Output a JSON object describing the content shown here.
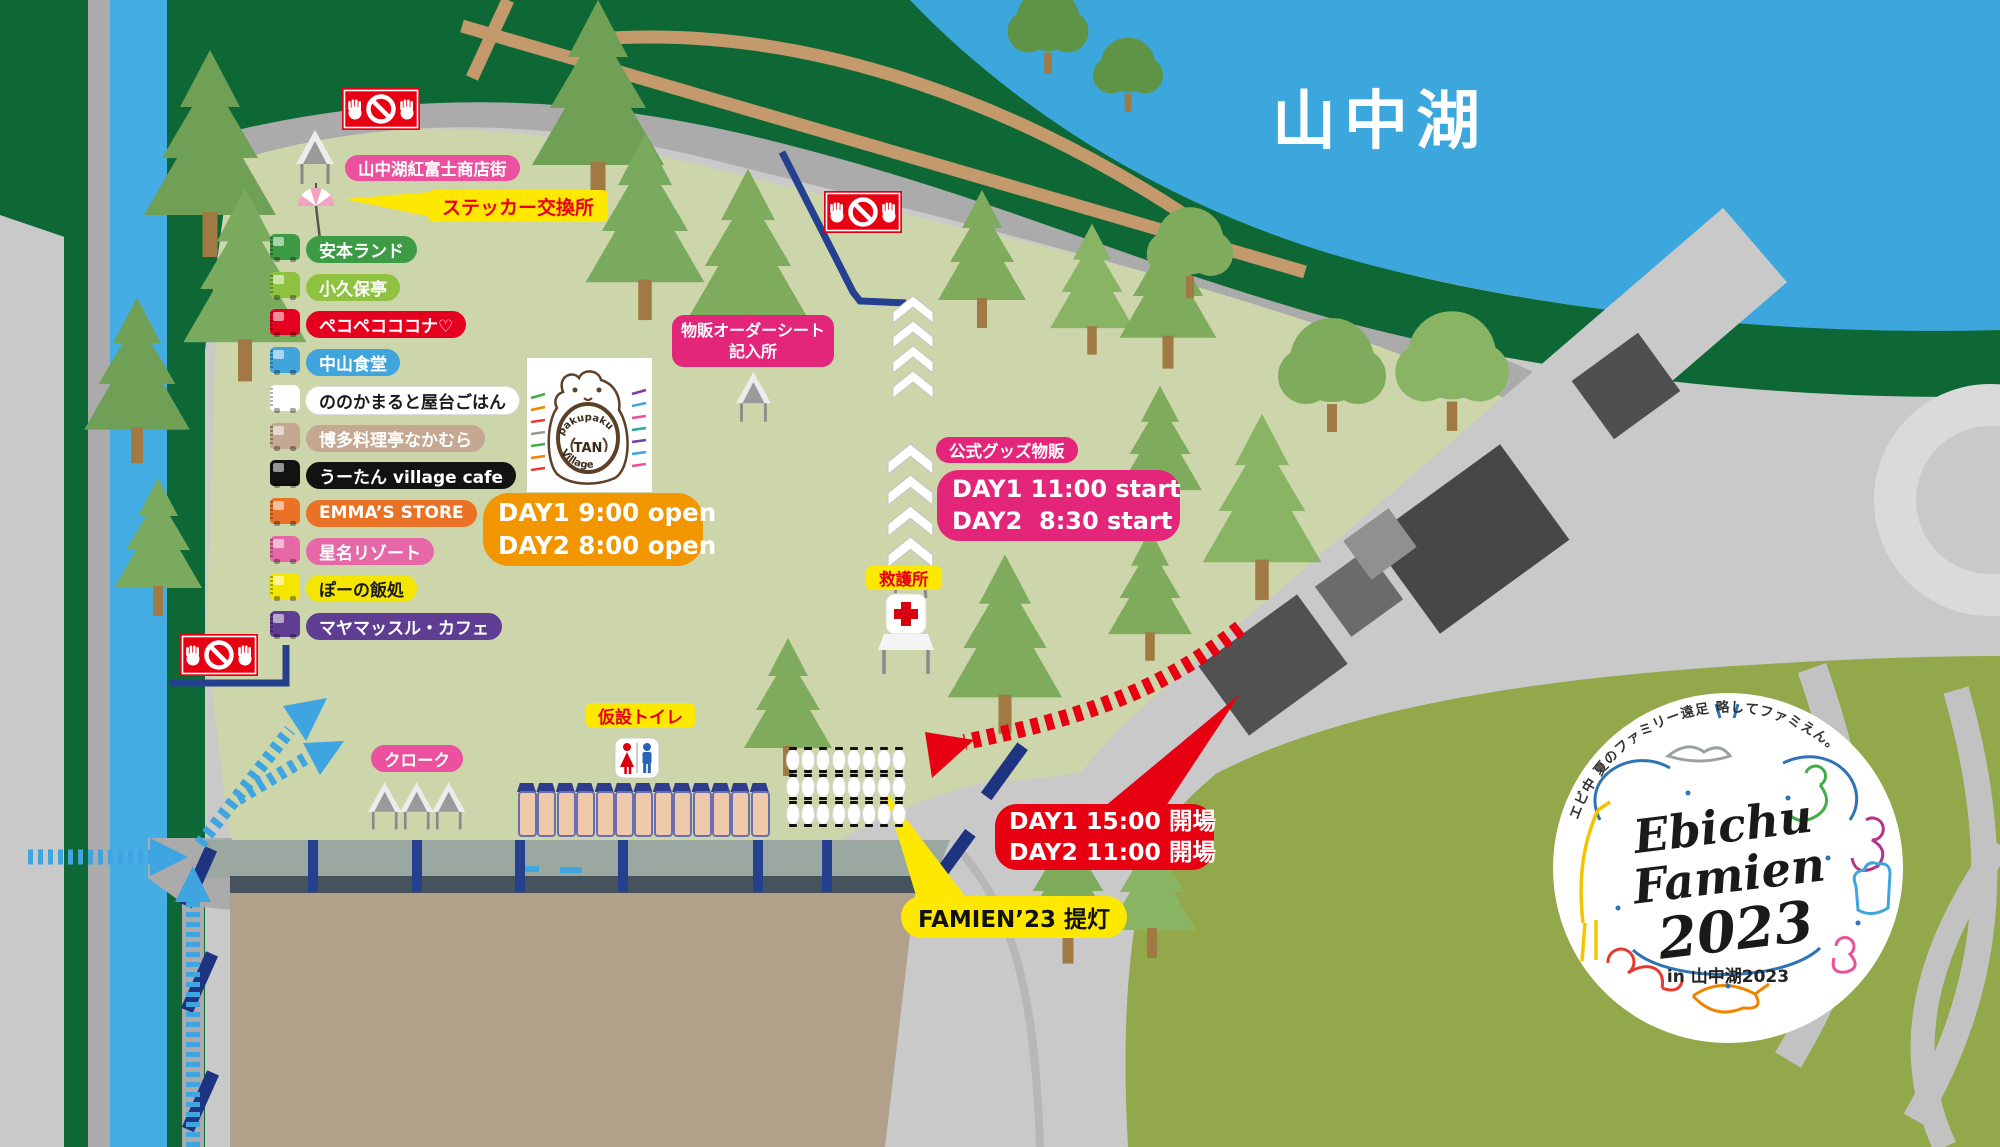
{
  "lake_label": "山中湖",
  "labels": {
    "shopping_street": "山中湖紅富士商店街",
    "sticker_exchange": "ステッカー交換所",
    "first_aid": "救護所",
    "temp_toilet": "仮設トイレ",
    "cloak": "クローク",
    "lantern": "FAMIEN’23 提灯"
  },
  "order_sheet": {
    "line1": "物販オーダーシート",
    "line2": "記入所"
  },
  "goods": {
    "title": "公式グッズ物販",
    "line1": "DAY1 11:00 start",
    "line2": "DAY2  8:30 start"
  },
  "gate_open": {
    "line1": "DAY1 9:00 open",
    "line2": "DAY2 8:00 open"
  },
  "entrance": {
    "line1": "DAY1 15:00 開場",
    "line2": "DAY2 11:00 開場"
  },
  "food_trucks": [
    {
      "label": "安本ランド",
      "color": "#3D9B46",
      "text": "#FFFFFF"
    },
    {
      "label": "小久保亭",
      "color": "#8FC241",
      "text": "#FFFFFF"
    },
    {
      "label": "ペコペコココナ♡",
      "color": "#E60020",
      "text": "#FFFFFF"
    },
    {
      "label": "中山食堂",
      "color": "#3FA5DC",
      "text": "#FFFFFF"
    },
    {
      "label": "ののかまると屋台ごはん",
      "color": "#FFFFFF",
      "text": "#1A1A1A"
    },
    {
      "label": "博多料理亭なかむら",
      "color": "#C5A891",
      "text": "#FFFFFF"
    },
    {
      "label": "うーたん village cafe",
      "color": "#121212",
      "text": "#FFFFFF"
    },
    {
      "label": "EMMA’S STORE",
      "color": "#E97226",
      "text": "#FFFFFF"
    },
    {
      "label": "星名リゾート",
      "color": "#E668A8",
      "text": "#FFFFFF"
    },
    {
      "label": "ぽーの飯処",
      "color": "#F5E600",
      "text": "#1A1A1A"
    },
    {
      "label": "マヤマッスル・カフェ",
      "color": "#5E3D93",
      "text": "#FFFFFF"
    }
  ],
  "hand_sign": {
    "line1": "pakupaku",
    "line2": "TAN",
    "line3": "Village"
  },
  "logo": {
    "tagline": "エビ中 夏のファミリー遠足 略してファミえん。",
    "word1": "Ebichu",
    "word2": "Famien",
    "year": "2023",
    "location": "in 山中湖2023"
  },
  "features": {
    "toilet_stalls": 13,
    "lantern_rows": 3,
    "lantern_cols": 8,
    "cloak_tents": 3,
    "no_entry_signs": 3
  },
  "colors": {
    "lake": "#3BA7DC",
    "river": "#44ADE4",
    "forest": "#0D6836",
    "venue": "#CDD5AA",
    "accent_pink": "#E3267A",
    "label_pink": "#EB519E",
    "accent_red": "#E60012",
    "accent_yellow": "#FFE800",
    "accent_orange": "#F29600",
    "fence_navy": "#24408F",
    "arrow_blue": "#3FA5E0",
    "stage_tan": "#B2A18A",
    "hill_green": "#92A84B"
  }
}
